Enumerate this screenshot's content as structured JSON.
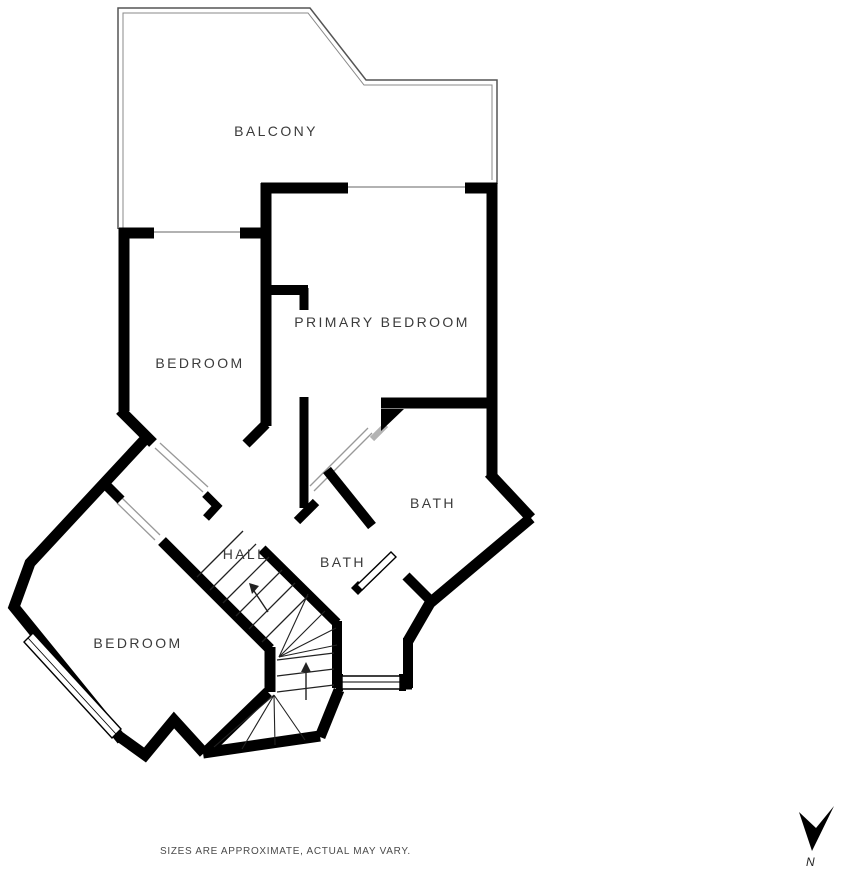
{
  "rooms": [
    {
      "label": "BALCONY",
      "x": 276,
      "y": 131
    },
    {
      "label": "BEDROOM",
      "x": 200,
      "y": 363
    },
    {
      "label": "PRIMARY BEDROOM",
      "x": 382,
      "y": 322
    },
    {
      "label": "BATH",
      "x": 433,
      "y": 503
    },
    {
      "label": "BATH",
      "x": 343,
      "y": 562
    },
    {
      "label": "HALL",
      "x": 245,
      "y": 554
    },
    {
      "label": "BEDROOM",
      "x": 138,
      "y": 643
    }
  ],
  "footer": {
    "disclaimer": "SIZES ARE APPROXIMATE, ACTUAL MAY VARY.",
    "north_label": "N"
  },
  "colors": {
    "wall": "#000000",
    "label_text": "#3b3b3b",
    "thin_line": "#999999",
    "balcony_outline": "#555555",
    "stair_line": "#222222"
  },
  "plan": {
    "balcony_outer": {
      "pts": [
        [
          118,
          229
        ],
        [
          118,
          8
        ],
        [
          310,
          8
        ],
        [
          366,
          80
        ],
        [
          497,
          80
        ],
        [
          497,
          184
        ]
      ],
      "w": 1.5,
      "c": "#555555"
    },
    "balcony_inner": {
      "pts": [
        [
          123,
          229
        ],
        [
          123,
          13
        ],
        [
          308,
          13
        ],
        [
          364,
          85
        ],
        [
          492,
          85
        ],
        [
          492,
          180
        ]
      ],
      "w": 1,
      "c": "#888888"
    },
    "walls": [
      {
        "pts": [
          [
            119,
            233
          ],
          [
            154,
            233
          ]
        ],
        "w": 11
      },
      {
        "pts": [
          [
            240,
            233
          ],
          [
            268,
            233
          ]
        ],
        "w": 11
      },
      {
        "pts": [
          [
            124,
            228
          ],
          [
            124,
            411
          ]
        ],
        "w": 11
      },
      {
        "pts": [
          [
            261,
            188
          ],
          [
            348,
            188
          ]
        ],
        "w": 11
      },
      {
        "pts": [
          [
            465,
            188
          ],
          [
            497,
            188
          ]
        ],
        "w": 11
      },
      {
        "pts": [
          [
            492,
            183
          ],
          [
            492,
            477
          ]
        ],
        "w": 11
      },
      {
        "pts": [
          [
            266,
            183
          ],
          [
            266,
            426
          ]
        ],
        "w": 11
      },
      {
        "pts": [
          [
            261,
            290
          ],
          [
            308,
            290
          ]
        ],
        "w": 10
      },
      {
        "pts": [
          [
            304,
            288
          ],
          [
            304,
            310
          ]
        ],
        "w": 9
      },
      {
        "pts": [
          [
            304,
            397
          ],
          [
            304,
            508
          ]
        ],
        "w": 9
      },
      {
        "pts": [
          [
            381,
            403
          ],
          [
            497,
            403
          ]
        ],
        "w": 11
      },
      {
        "pts": [
          [
            120,
            410
          ],
          [
            153,
            443
          ]
        ],
        "w": 11
      },
      {
        "pts": [
          [
            205,
            494
          ],
          [
            217,
            506
          ],
          [
            206,
            518
          ]
        ],
        "w": 8
      },
      {
        "pts": [
          [
            107,
            486
          ],
          [
            121,
            500
          ]
        ],
        "w": 10
      },
      {
        "pts": [
          [
            162,
            541
          ],
          [
            270,
            649
          ]
        ],
        "w": 11
      },
      {
        "pts": [
          [
            270,
            647
          ],
          [
            270,
            692
          ]
        ],
        "w": 11
      },
      {
        "pts": [
          [
            268,
            692
          ],
          [
            206,
            752
          ]
        ],
        "w": 11
      },
      {
        "pts": [
          [
            120,
            737
          ],
          [
            145,
            755
          ],
          [
            174,
            720
          ],
          [
            204,
            753
          ]
        ],
        "w": 11
      },
      {
        "pts": [
          [
            203,
            753
          ],
          [
            320,
            736
          ]
        ],
        "w": 11
      },
      {
        "pts": [
          [
            320,
            737
          ],
          [
            339,
            690
          ]
        ],
        "w": 11
      },
      {
        "pts": [
          [
            336,
            683
          ],
          [
            412,
            683
          ]
        ],
        "w": 13
      },
      {
        "pts": [
          [
            408,
            688
          ],
          [
            408,
            638
          ]
        ],
        "w": 10
      },
      {
        "pts": [
          [
            408,
            641
          ],
          [
            430,
            603
          ],
          [
            531,
            518
          ]
        ],
        "w": 11
      },
      {
        "pts": [
          [
            531,
            518
          ],
          [
            489,
            473
          ]
        ],
        "w": 11
      },
      {
        "pts": [
          [
            148,
            436
          ],
          [
            30,
            563
          ],
          [
            14,
            607
          ],
          [
            122,
            740
          ]
        ],
        "w": 11
      },
      {
        "pts": [
          [
            266,
            424
          ],
          [
            246,
            444
          ]
        ],
        "w": 10
      },
      {
        "pts": [
          [
            316,
            502
          ],
          [
            297,
            521
          ]
        ],
        "w": 9
      },
      {
        "pts": [
          [
            327,
            470
          ],
          [
            372,
            526
          ]
        ],
        "w": 10
      },
      {
        "pts": [
          [
            406,
            576
          ],
          [
            431,
            601
          ]
        ],
        "w": 10
      },
      {
        "pts": [
          [
            262,
            549
          ],
          [
            337,
            623
          ]
        ],
        "w": 10
      },
      {
        "pts": [
          [
            337,
            621
          ],
          [
            337,
            688
          ]
        ],
        "w": 10
      }
    ],
    "fills": [
      [
        [
          381,
          409
        ],
        [
          404,
          409
        ],
        [
          381,
          431
        ]
      ],
      [
        [
          336,
          674
        ],
        [
          343,
          674
        ],
        [
          343,
          691
        ],
        [
          336,
          691
        ]
      ],
      [
        [
          399,
          674
        ],
        [
          406,
          674
        ],
        [
          406,
          691
        ],
        [
          399,
          691
        ]
      ],
      [
        [
          358,
          581
        ],
        [
          365,
          588
        ],
        [
          358,
          595
        ],
        [
          351,
          588
        ]
      ]
    ],
    "windows": [
      {
        "poly": [
          [
            24,
            642
          ],
          [
            33,
            633
          ],
          [
            121,
            729
          ],
          [
            112,
            738
          ]
        ],
        "mid": [
          28,
          638,
          116,
          734
        ]
      },
      {
        "poly": [
          [
            342,
            676
          ],
          [
            400,
            676
          ],
          [
            400,
            689
          ],
          [
            342,
            689
          ]
        ],
        "mid": [
          342,
          682,
          400,
          682
        ]
      },
      {
        "poly": [
          [
            357,
            585
          ],
          [
            391,
            552
          ],
          [
            396,
            557
          ],
          [
            362,
            590
          ]
        ],
        "mid": null
      }
    ],
    "thin_lines": [
      {
        "pts": [
          [
            153,
            232
          ],
          [
            240,
            232
          ]
        ],
        "w": 1.5,
        "c": "#999999"
      },
      {
        "pts": [
          [
            348,
            187
          ],
          [
            465,
            187
          ]
        ],
        "w": 1.5,
        "c": "#999999"
      },
      {
        "pts": [
          [
            160,
            443
          ],
          [
            208,
            487
          ]
        ],
        "w": 1.3,
        "c": "#999999"
      },
      {
        "pts": [
          [
            155,
            448
          ],
          [
            203,
            492
          ]
        ],
        "w": 1.3,
        "c": "#999999"
      },
      {
        "pts": [
          [
            122,
            498
          ],
          [
            160,
            535
          ]
        ],
        "w": 1.3,
        "c": "#999999"
      },
      {
        "pts": [
          [
            117,
            503
          ],
          [
            155,
            540
          ]
        ],
        "w": 1.3,
        "c": "#999999"
      },
      {
        "pts": [
          [
            310,
            486
          ],
          [
            368,
            428
          ]
        ],
        "w": 1.3,
        "c": "#999999"
      },
      {
        "pts": [
          [
            314,
            491
          ],
          [
            372,
            433
          ]
        ],
        "w": 1.3,
        "c": "#999999"
      },
      {
        "pts": [
          [
            372,
            439
          ],
          [
            386,
            425
          ]
        ],
        "w": 6,
        "c": "#b3b3b3"
      }
    ],
    "stairs": {
      "treads": [
        [
          197,
          577,
          243,
          531
        ],
        [
          210,
          590,
          256,
          544
        ],
        [
          223,
          603,
          269,
          557
        ],
        [
          236,
          616,
          282,
          570
        ],
        [
          249,
          629,
          295,
          583
        ],
        [
          262,
          642,
          308,
          596
        ],
        [
          277,
          660,
          334,
          653
        ],
        [
          277,
          676,
          334,
          669
        ],
        [
          277,
          692,
          334,
          685
        ]
      ],
      "rays": [
        [
          279,
          657,
          308,
          594
        ],
        [
          279,
          657,
          325,
          611
        ],
        [
          279,
          657,
          336,
          628
        ],
        [
          279,
          657,
          337,
          645
        ],
        [
          274,
          695,
          214,
          747
        ],
        [
          274,
          695,
          242,
          749
        ],
        [
          274,
          695,
          275,
          745
        ],
        [
          274,
          695,
          305,
          740
        ]
      ],
      "arrows": [
        {
          "line": [
            268,
            612,
            252,
            588
          ],
          "head": [
            [
              249,
              583
            ],
            [
              259,
              586
            ],
            [
              252,
              594
            ]
          ]
        },
        {
          "line": [
            306,
            700,
            306,
            668
          ],
          "head": [
            [
              306,
              662
            ],
            [
              301,
              672
            ],
            [
              311,
              672
            ]
          ]
        }
      ]
    },
    "north_arrow": [
      [
        812,
        851
      ],
      [
        799,
        812
      ],
      [
        816,
        828
      ],
      [
        834,
        806
      ]
    ]
  }
}
